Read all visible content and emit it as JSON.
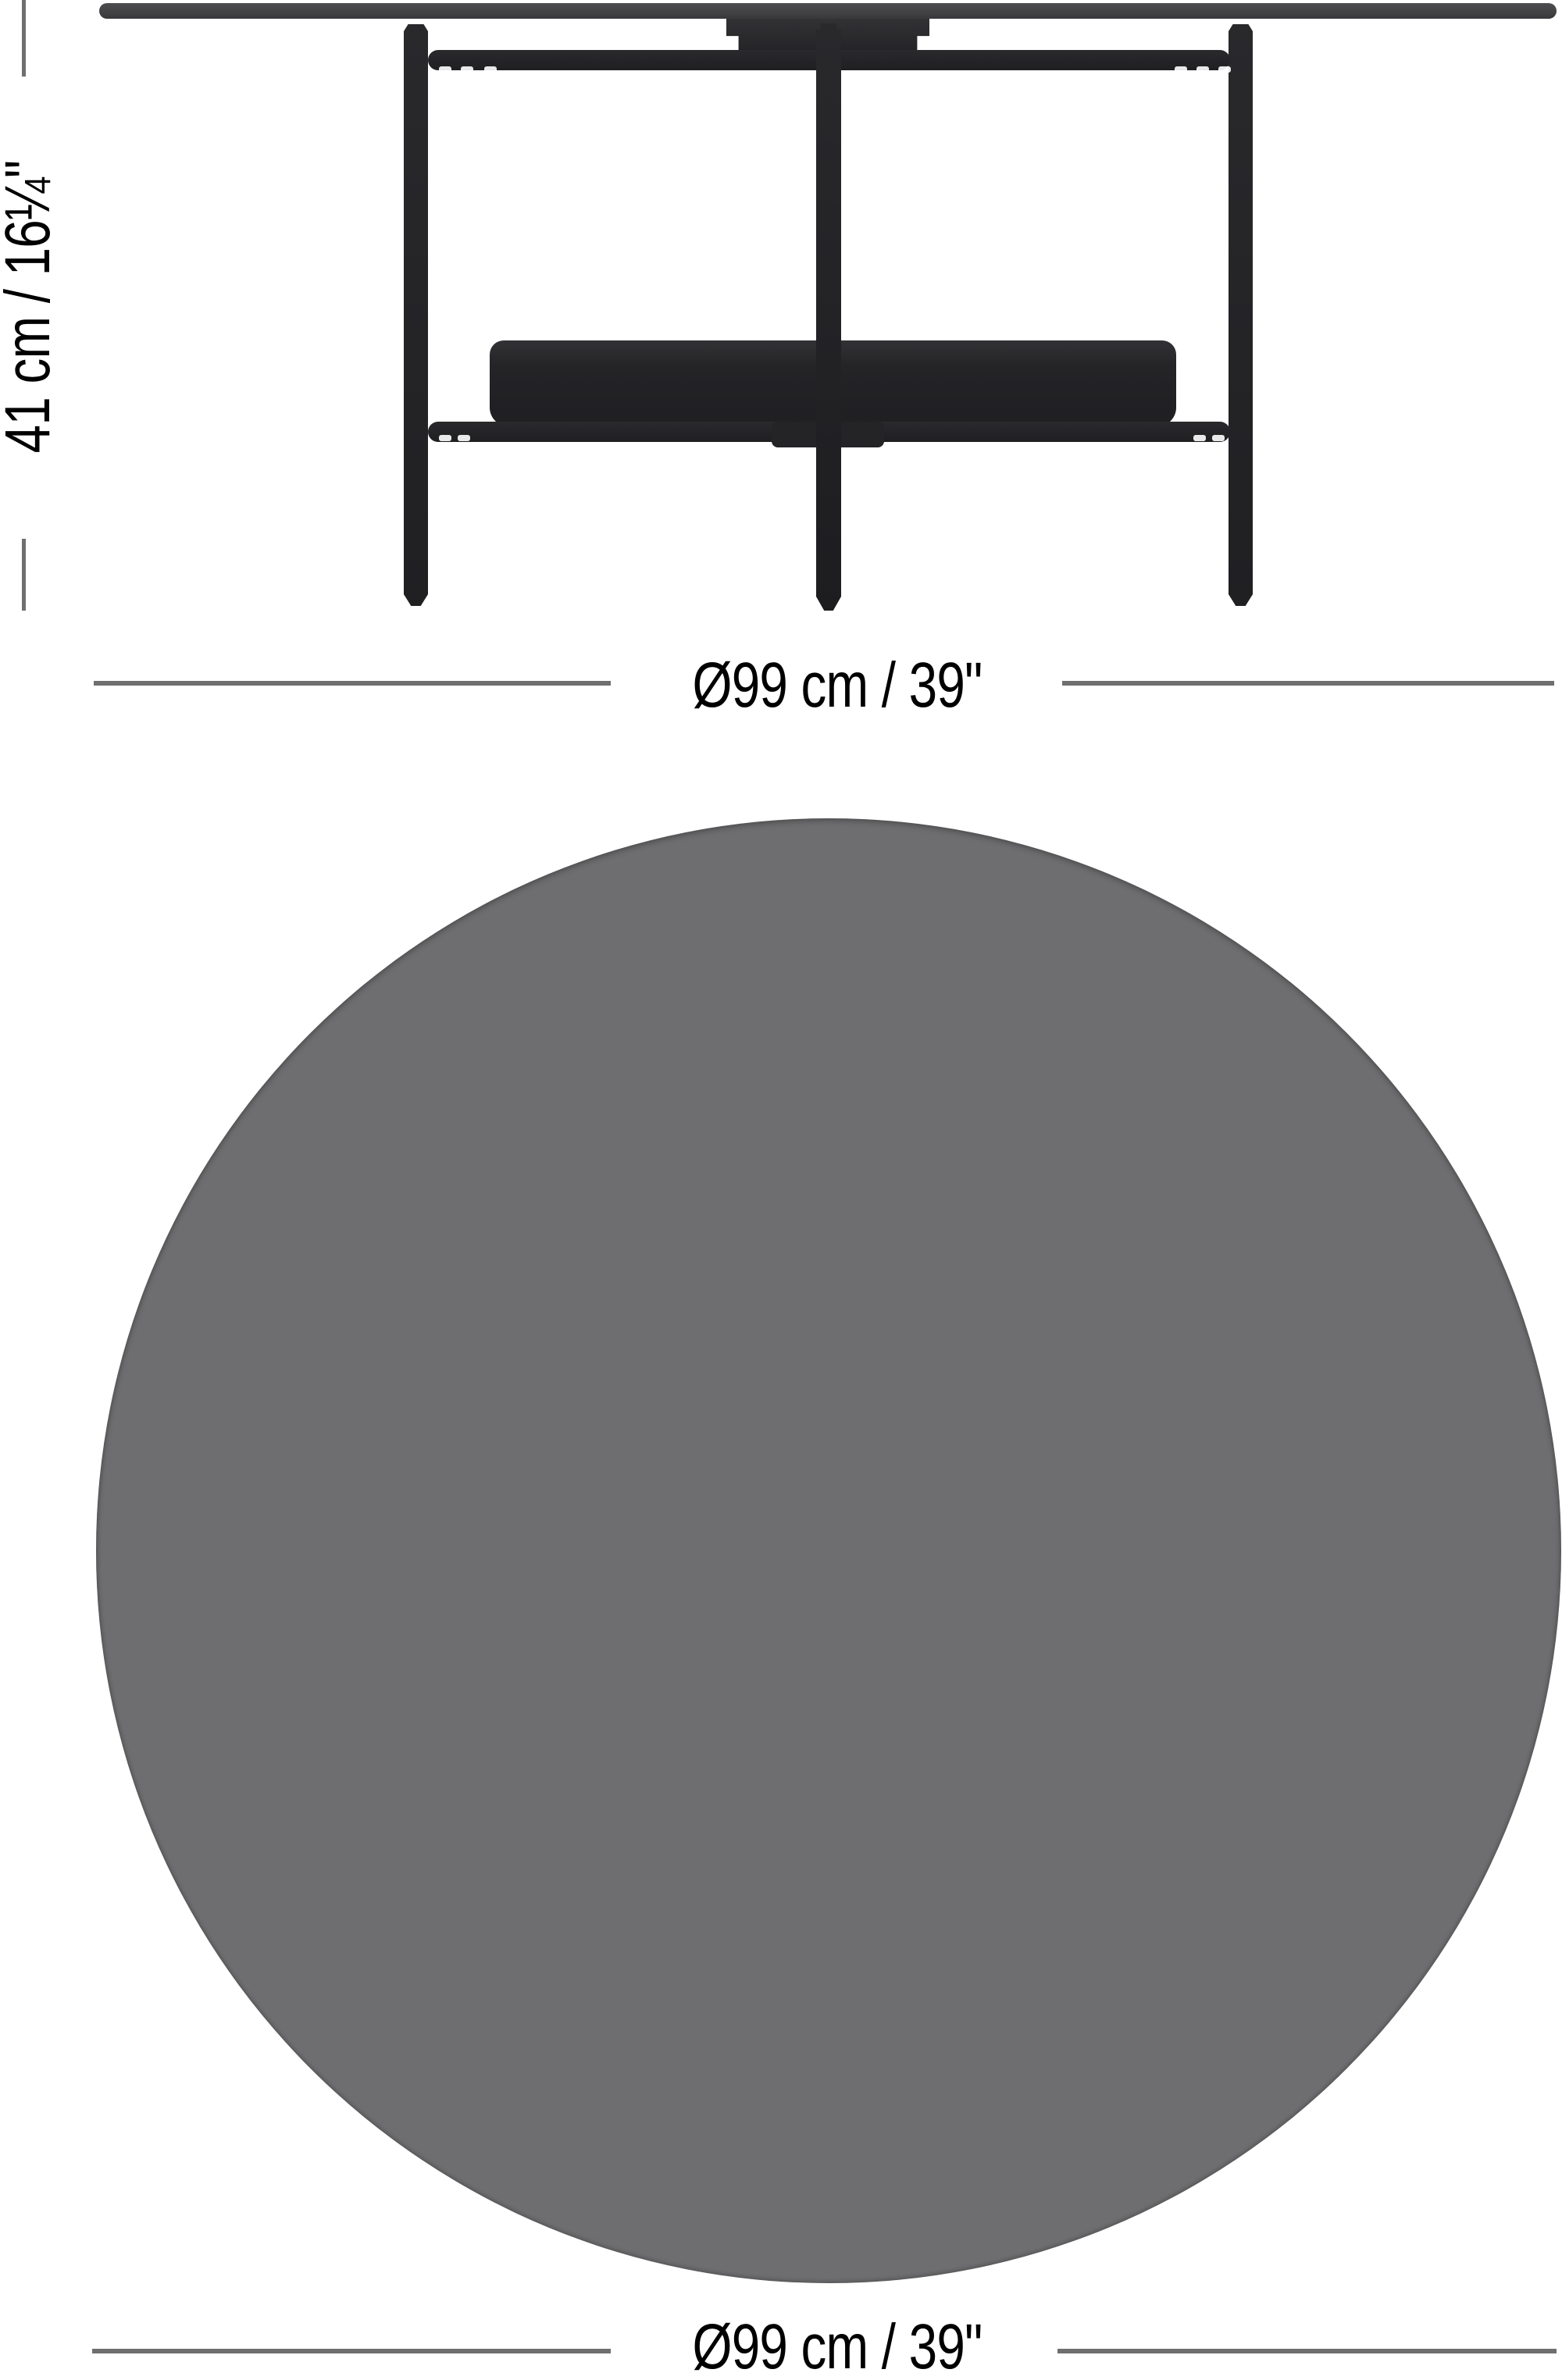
{
  "diagram": {
    "type": "furniture-dimension-diagram",
    "views": {
      "side_view": "round coffee table with lower shelf tray, two outer legs and center post",
      "top_view": "plain gray circle representing the round tabletop"
    }
  },
  "labels": {
    "height": "41 cm / 16¼\"",
    "diameter_top": "Ø99 cm / 39\"",
    "diameter_bottom": "Ø99 cm / 39\""
  },
  "colors": {
    "bg": "#ffffff",
    "tabletop": "#47474a",
    "frame": "#232326",
    "tray": "#212124",
    "circle": "#6e6e70",
    "dimline": "#6f6f6f",
    "text": "#000000"
  }
}
